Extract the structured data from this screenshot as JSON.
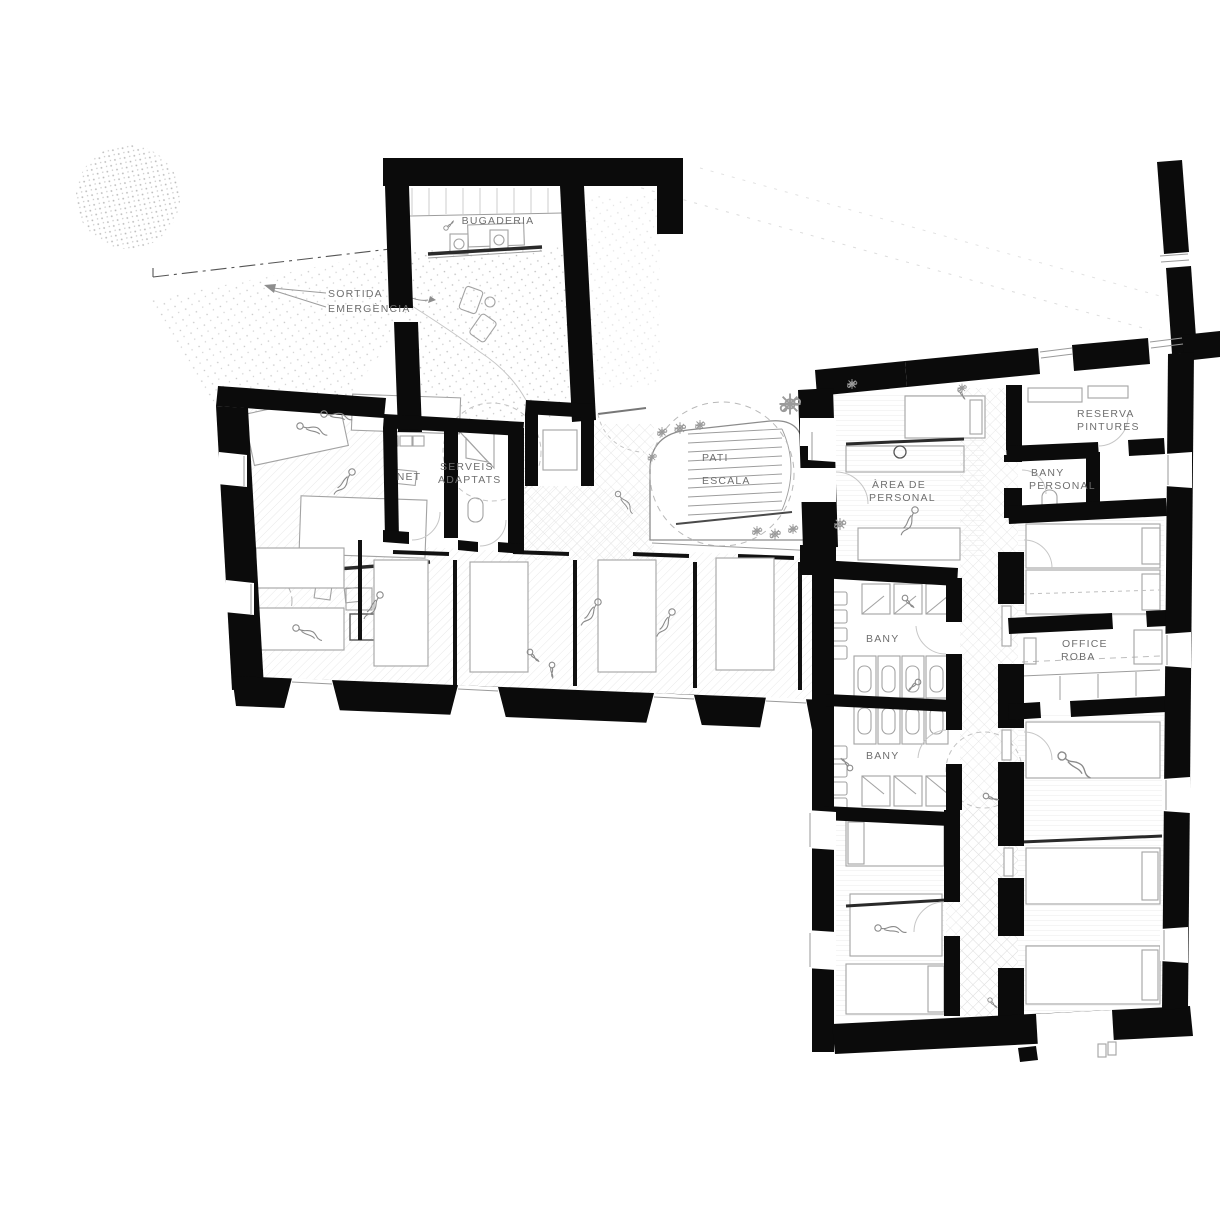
{
  "plan_labels": {
    "bugaderia": "BUGADERIA",
    "sortida_1": "SORTIDA",
    "sortida_2": "EMERGÈNCIA",
    "net": "NET",
    "serveis_1": "SERVEIS",
    "serveis_2": "ADAPTATS",
    "pati_1": "PATI",
    "pati_2": "ESCALA",
    "area_personal_1": "ÀREA DE",
    "area_personal_2": "PERSONAL",
    "reserva_1": "RESERVA",
    "reserva_2": "PINTURES",
    "bany_personal_1": "BANY",
    "bany_personal_2": "PERSONAL",
    "office_roba_1": "OFFICE",
    "office_roba_2": "ROBA",
    "bany_upper": "BANY",
    "bany_lower": "BANY"
  },
  "colors": {
    "wall": "#0b0b0b",
    "label_text": "#6f6f6f",
    "furniture_line": "#a3a3a3",
    "background": "#ffffff"
  }
}
